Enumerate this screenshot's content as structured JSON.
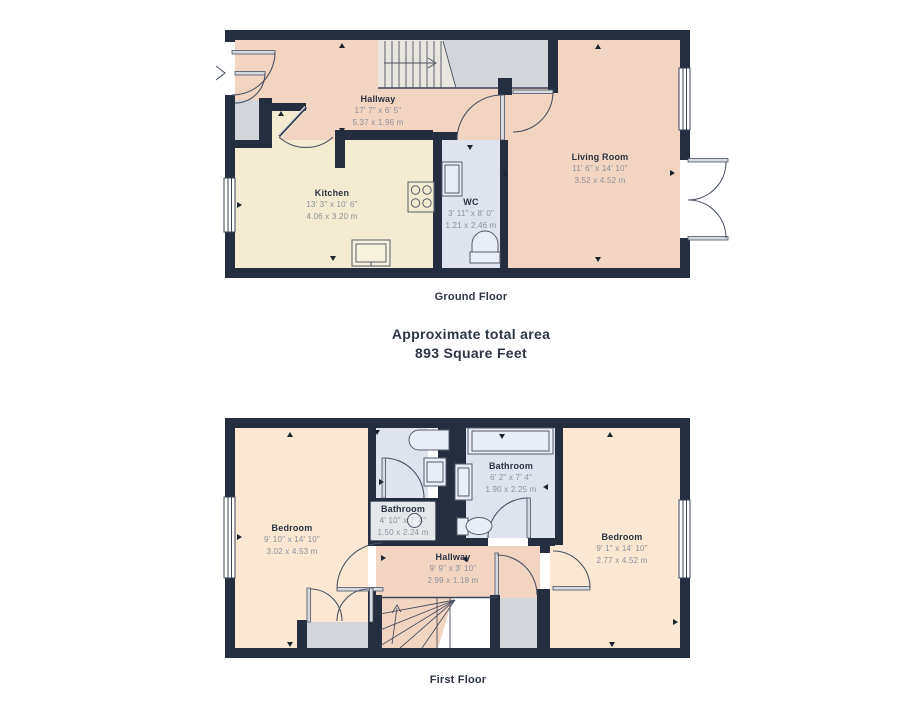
{
  "summary": {
    "title": "Approximate total area",
    "value": "893 Square Feet"
  },
  "floors": [
    {
      "name": "Ground Floor",
      "rooms": [
        {
          "name": "Hallway",
          "imperial": "17' 7\" x 6' 5\"",
          "metric": "5.37 x 1.96 m"
        },
        {
          "name": "Kitchen",
          "imperial": "13' 3\" x 10' 6\"",
          "metric": "4.06 x 3.20 m"
        },
        {
          "name": "WC",
          "imperial": "3' 11\" x 8' 0\"",
          "metric": "1.21 x 2.46 m"
        },
        {
          "name": "Living Room",
          "imperial": "11' 6\" x 14' 10\"",
          "metric": "3.52 x 4.52 m"
        }
      ]
    },
    {
      "name": "First Floor",
      "rooms": [
        {
          "name": "Bedroom",
          "imperial": "9' 10\" x 14' 10\"",
          "metric": "3.02 x 4.53 m"
        },
        {
          "name": "Bathroom",
          "imperial": "4' 10\" x 7' 4\"",
          "metric": "1.50 x 2.24 m"
        },
        {
          "name": "Bathroom",
          "imperial": "6' 2\" x 7' 4\"",
          "metric": "1.90 x 2.25 m"
        },
        {
          "name": "Hallway",
          "imperial": "9' 9\" x 3' 10\"",
          "metric": "2.99 x 1.18 m"
        },
        {
          "name": "Bedroom",
          "imperial": "9' 1\" x 14' 10\"",
          "metric": "2.77 x 4.52 m"
        }
      ]
    }
  ],
  "colors": {
    "wall": "#242e3e",
    "hallway_living": "#f2d4c3",
    "kitchen": "#f3ecd2",
    "bathroom": "#dfe3ee",
    "bedroom": "#fbe7d2",
    "storage_grey": "#d2d5d9",
    "stairs": "#e9e6df"
  }
}
